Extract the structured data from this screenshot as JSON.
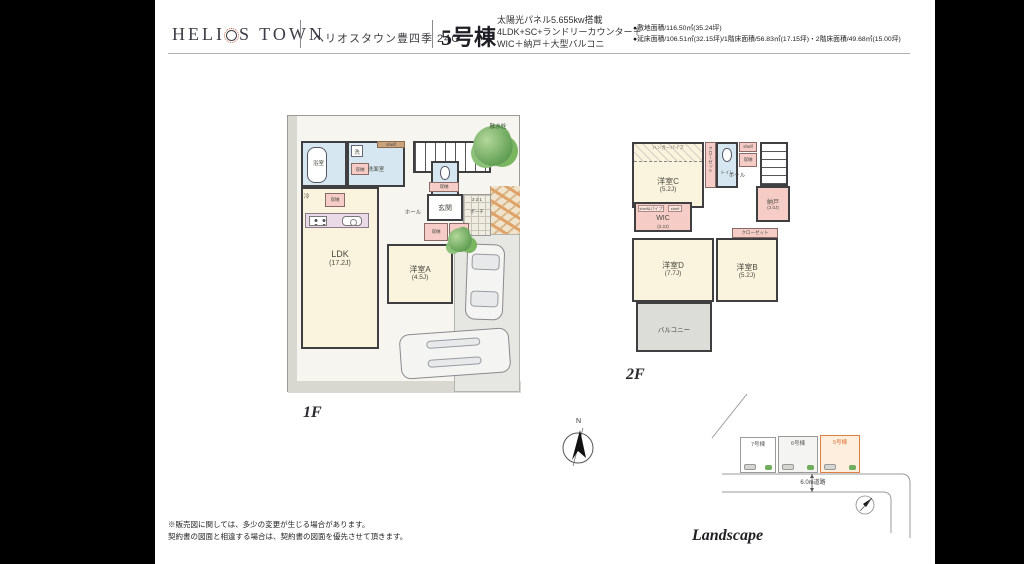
{
  "header": {
    "logo_pre": "HELI",
    "logo_post": "S TOWN",
    "project": "ヘリオスタウン豊四季 24G",
    "unit": "5号棟",
    "spec1": "太陽光パネル5.655kw搭載",
    "spec2": "4LDK+SC+ランドリーカウンター＋",
    "spec3": "WIC＋納戸＋大型バルコニ",
    "area1": "●敷地面積/116.50㎡(35.24坪)",
    "area2": "●延床面積/106.51㎡(32.15坪)/1階床面積/56.83㎡(17.15坪)・2階床面積/49.68㎡(15.00坪)"
  },
  "floor1": {
    "label": "1F",
    "ldk": "LDK",
    "ldk_area": "(17.2J)",
    "roomA": "洋室A",
    "roomA_area": "(4.5J)",
    "bath": "浴室",
    "wash": "洗面室",
    "washer": "洗",
    "fridge": "冷",
    "shelf": "shelf",
    "storage": "収納",
    "toilet": "トイレ",
    "hall": "ホール",
    "entry": "玄関",
    "porch": "ポーチ",
    "steps": "3 2 1",
    "sc": "SC",
    "tap": "散水栓"
  },
  "floor2": {
    "label": "2F",
    "roomB": "洋室B",
    "roomB_area": "(5.2J)",
    "roomC": "洋室C",
    "roomC_area": "(5.2J)",
    "roomD": "洋室D",
    "roomD_area": "(7.7J)",
    "wic": "WIC",
    "wic_area": "(2.2J)",
    "nando": "納戸",
    "nando_area": "(2.0J)",
    "toilet": "トイレ",
    "hall": "ホール",
    "closet": "クローゼット",
    "hanger": "ハンガーパイプ",
    "shelf_pipe": "shelf&パイプ",
    "shelf": "shelf",
    "storage": "収納",
    "balcony": "バルコニー"
  },
  "compass": {
    "north": "N"
  },
  "landscape": {
    "title": "Landscape",
    "lot7": "7号棟",
    "lot6": "6号棟",
    "lot5": "5号棟",
    "road": "6.0m道路"
  },
  "disclaimer": {
    "line1": "※販売図に関しては、多少の変更が生じる場合があります。",
    "line2": "契約書の図面と相違する場合は、契約書の図面を優先させて頂きます。"
  },
  "colors": {
    "accent_orange": "#e07030",
    "room_cream": "#faf3dd",
    "storage_pink": "#f5cdc6",
    "wet_blue": "#d6e7f1",
    "wall": "#3f3f42"
  }
}
